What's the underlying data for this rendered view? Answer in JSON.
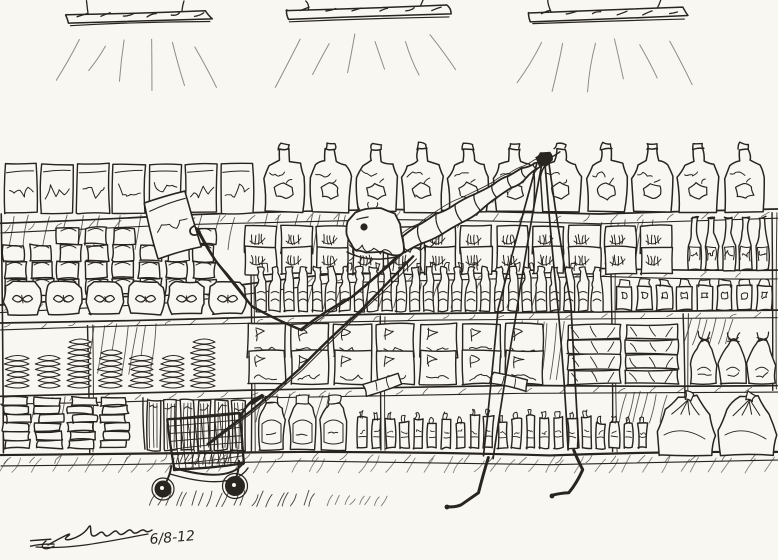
{
  "artwork": {
    "description": "Pen-and-ink cartoon drawing of a gaunt skeletal creature with extremely long thin legs browsing grocery store shelves, grabbing a box with one long arm, with an empty shopping cart below and three fluorescent ceiling lights above.",
    "medium": "ink-sketch"
  },
  "signature": {
    "date": "6/8-12"
  },
  "scene": {
    "ink": "#28241f",
    "paper": "#f9f7f2",
    "lights": [
      {
        "x1": 66,
        "x2": 206,
        "y": 12
      },
      {
        "x1": 286,
        "x2": 446,
        "y": 7
      },
      {
        "x1": 528,
        "x2": 682,
        "y": 10
      }
    ],
    "shelf_lines": [
      {
        "pts": [
          [
            0,
            224
          ],
          [
            180,
            215
          ],
          [
            390,
            210
          ],
          [
            600,
            214
          ],
          [
            778,
            209
          ]
        ],
        "band": 9
      },
      {
        "pts": [
          [
            0,
            305
          ],
          [
            180,
            294
          ],
          [
            330,
            274
          ],
          [
            600,
            269
          ],
          [
            778,
            271
          ]
        ],
        "band": 8
      },
      {
        "pts": [
          [
            0,
            322
          ],
          [
            250,
            317
          ],
          [
            430,
            313
          ],
          [
            778,
            311
          ]
        ],
        "band": 7
      },
      {
        "pts": [
          [
            0,
            396
          ],
          [
            250,
            390
          ],
          [
            520,
            386
          ],
          [
            778,
            385
          ]
        ],
        "band": 8
      },
      {
        "pts": [
          [
            0,
            455
          ],
          [
            300,
            451
          ],
          [
            550,
            455
          ],
          [
            778,
            451
          ]
        ],
        "band": 10
      }
    ],
    "posts": [
      {
        "x": 88,
        "y1": 325,
        "y2": 452
      },
      {
        "x": 143,
        "y1": 398,
        "y2": 450
      },
      {
        "x": 250,
        "y1": 226,
        "y2": 452
      },
      {
        "x": 380,
        "y1": 316,
        "y2": 450
      },
      {
        "x": 612,
        "y1": 272,
        "y2": 452
      },
      {
        "x": 684,
        "y1": 314,
        "y2": 452
      },
      {
        "x": 772,
        "y1": 212,
        "y2": 390
      }
    ],
    "hatch_patches": [
      {
        "x": 4,
        "y": 216,
        "w": 240,
        "h": 34,
        "n": 13
      },
      {
        "x": 262,
        "y": 215,
        "w": 120,
        "h": 40,
        "n": 9
      },
      {
        "x": 300,
        "y": 282,
        "w": 300,
        "h": 26,
        "n": 16
      },
      {
        "x": 598,
        "y": 222,
        "w": 60,
        "h": 42,
        "n": 7
      },
      {
        "x": 90,
        "y": 326,
        "w": 70,
        "h": 48,
        "n": 7
      },
      {
        "x": 520,
        "y": 322,
        "w": 45,
        "h": 58,
        "n": 7
      },
      {
        "x": 688,
        "y": 318,
        "w": 50,
        "h": 26,
        "n": 6
      },
      {
        "x": 258,
        "y": 394,
        "w": 80,
        "h": 28,
        "n": 7
      },
      {
        "x": 8,
        "y": 398,
        "w": 60,
        "h": 30,
        "n": 6
      },
      {
        "x": 620,
        "y": 394,
        "w": 50,
        "h": 28,
        "n": 6
      }
    ],
    "sections": [
      {
        "type": "cereal-box",
        "label": "cereal-boxes",
        "x": 4,
        "xEnd": 256,
        "yBase": 213,
        "w": 36,
        "h": 49
      },
      {
        "type": "jug",
        "label": "juice-jugs",
        "x": 262,
        "xEnd": 776,
        "yBase": 212,
        "w": 46,
        "h": 60
      },
      {
        "type": "can-stack",
        "label": "canned-goods",
        "x": 4,
        "xEnd": 240,
        "yBase": 295,
        "w": 27,
        "h": 68
      },
      {
        "type": "tally-box",
        "label": "boxed-goods",
        "x": 244,
        "xEnd": 680,
        "yBase": 274,
        "w": 36,
        "h": 27,
        "rows": 2
      },
      {
        "type": "wine-bottle",
        "label": "wine-bottles",
        "x": 686,
        "xEnd": 778,
        "yBase": 270,
        "w": 17,
        "h": 56
      },
      {
        "type": "bag",
        "label": "snack-bags",
        "x": 2,
        "xEnd": 250,
        "yBase": 314,
        "w": 41,
        "h": 34
      },
      {
        "type": "water-bottle",
        "label": "water-bottles",
        "x": 254,
        "xEnd": 610,
        "yBase": 311,
        "w": 14,
        "h": 42
      },
      {
        "type": "small-jar",
        "label": "small-jars",
        "x": 616,
        "xEnd": 776,
        "yBase": 310,
        "w": 20,
        "h": 34
      },
      {
        "type": "disc-stack",
        "label": "stacked-tins",
        "x": 4,
        "xEnd": 240,
        "yBase": 390,
        "w": 31,
        "h": 60
      },
      {
        "type": "flag-pack",
        "label": "wrapped-packs",
        "x": 246,
        "xEnd": 558,
        "yBase": 384,
        "w": 43,
        "h": 33,
        "rows": 2
      },
      {
        "type": "loaf",
        "label": "bread-loaves",
        "x": 566,
        "xEnd": 686,
        "yBase": 384,
        "w": 58,
        "h": 16,
        "rows": 4
      },
      {
        "type": "sack",
        "label": "tied-sacks",
        "x": 690,
        "xEnd": 778,
        "yBase": 384,
        "w": 29,
        "h": 54
      },
      {
        "type": "flat-stack",
        "label": "flat-packs",
        "x": 2,
        "xEnd": 138,
        "yBase": 448,
        "w": 33,
        "h": 52
      },
      {
        "type": "stick-box",
        "label": "striped-boxes",
        "x": 146,
        "xEnd": 248,
        "yBase": 450,
        "w": 17,
        "h": 50
      },
      {
        "type": "label-jar",
        "label": "jars",
        "x": 256,
        "xEnd": 352,
        "yBase": 450,
        "w": 31,
        "h": 54
      },
      {
        "type": "vial",
        "label": "bottles-vials",
        "x": 356,
        "xEnd": 650,
        "yBase": 448,
        "w": 14,
        "h": 36
      },
      {
        "type": "big-sack",
        "label": "floor-sacks",
        "x": 656,
        "xEnd": 778,
        "yBase": 455,
        "w": 61,
        "h": 62
      }
    ],
    "tilted_tubes": [
      {
        "x": 366,
        "y": 390,
        "rot": -18
      },
      {
        "x": 490,
        "y": 387,
        "rot": 14
      }
    ],
    "creature": {
      "spine_top": [
        [
          402,
          236
        ],
        [
          418,
          226
        ],
        [
          436,
          215
        ],
        [
          455,
          204
        ],
        [
          474,
          194
        ],
        [
          492,
          184
        ],
        [
          508,
          175
        ],
        [
          522,
          168
        ],
        [
          534,
          163
        ],
        [
          544,
          160
        ]
      ],
      "spine_bot": [
        [
          404,
          252
        ],
        [
          422,
          244
        ],
        [
          442,
          234
        ],
        [
          462,
          222
        ],
        [
          480,
          210
        ],
        [
          497,
          198
        ],
        [
          512,
          188
        ],
        [
          526,
          178
        ],
        [
          537,
          169
        ],
        [
          546,
          163
        ]
      ],
      "arm_to_box": [
        [
          404,
          250
        ],
        [
          352,
          296
        ],
        [
          300,
          330
        ],
        [
          252,
          306
        ],
        [
          216,
          262
        ],
        [
          196,
          228
        ]
      ],
      "arm_to_cart": [
        [
          414,
          257
        ],
        [
          360,
          310
        ],
        [
          300,
          370
        ],
        [
          250,
          412
        ],
        [
          207,
          444
        ]
      ],
      "box": {
        "x": 150,
        "y": 196,
        "w": 44,
        "h": 58,
        "rot": -15
      },
      "legs": [
        {
          "edges": [
            [
              [
                536,
                163
              ],
              [
                498,
                310
              ],
              [
                484,
                455
              ]
            ],
            [
              [
                542,
                164
              ],
              [
                516,
                318
              ],
              [
                493,
                458
              ]
            ]
          ],
          "foot": [
            [
              489,
              458
            ],
            [
              478,
              492
            ],
            [
              461,
              505
            ],
            [
              447,
              507
            ]
          ]
        },
        {
          "edges": [
            [
              [
                544,
                161
              ],
              [
                557,
                305
              ],
              [
                569,
                450
              ]
            ],
            [
              [
                548,
                160
              ],
              [
                571,
                304
              ],
              [
                579,
                448
              ]
            ]
          ],
          "foot": [
            [
              574,
              449
            ],
            [
              583,
              470
            ],
            [
              568,
              492
            ],
            [
              552,
              496
            ]
          ]
        }
      ]
    },
    "cart": {
      "basket": {
        "tl": [
          168,
          420
        ],
        "tr": [
          240,
          413
        ],
        "br": [
          244,
          464
        ],
        "bl": [
          174,
          470
        ]
      },
      "handle": [
        [
          240,
          416
        ],
        [
          252,
          401
        ],
        [
          260,
          395
        ]
      ],
      "wheels": [
        [
          163,
          489,
          8.5
        ],
        [
          235,
          486,
          10
        ]
      ]
    }
  }
}
